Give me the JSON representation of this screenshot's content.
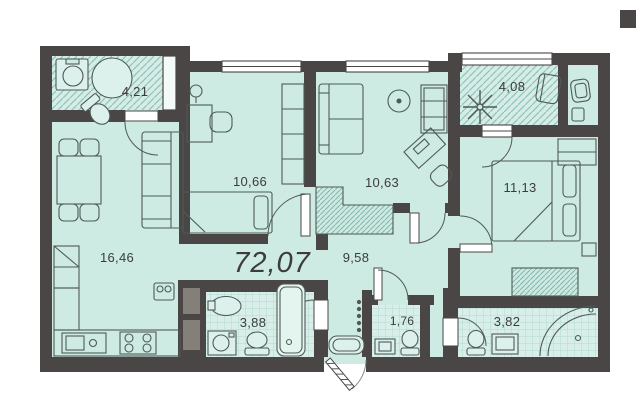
{
  "plan": {
    "total_area_label": "72,07",
    "rooms": {
      "bathroom_top": {
        "area": "4,21"
      },
      "room_mid_left": {
        "area": "10,66"
      },
      "room_mid_right": {
        "area": "10,63"
      },
      "loggia": {
        "area": "4,08"
      },
      "bedroom": {
        "area": "11,13"
      },
      "kitchen_living": {
        "area": "16,46"
      },
      "hall": {
        "area": "9,58"
      },
      "bathroom_main": {
        "area": "3,88"
      },
      "wc": {
        "area": "1,76"
      },
      "shower_room": {
        "area": "3,82"
      }
    },
    "colors": {
      "room_fill": "#cdeae3",
      "wall": "#4a4645",
      "hatch_line": "#8fc3b8",
      "tile_line": "#b3d8d1",
      "furniture_line": "#4f5a56",
      "text": "#3d3c3c",
      "fixture_fill": "#e4f4ef"
    }
  }
}
